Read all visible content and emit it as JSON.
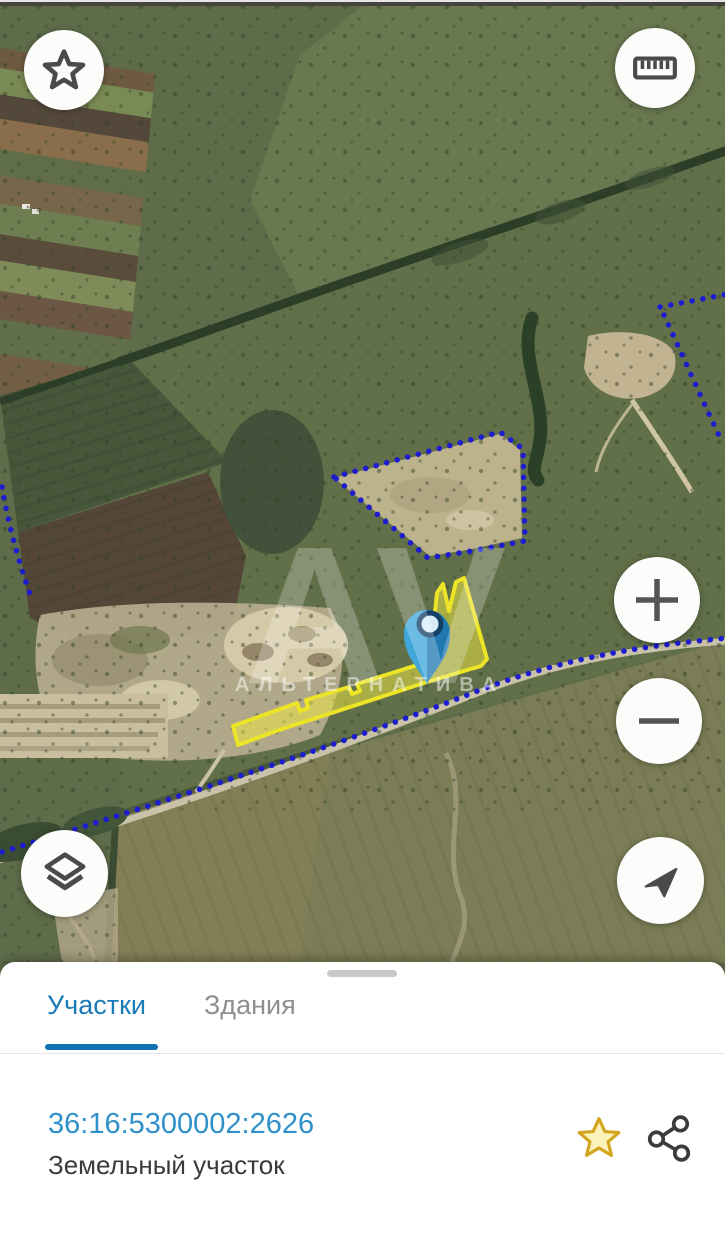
{
  "map": {
    "watermark": {
      "monogram": "АV",
      "name": "АЛЬТЕРНАТИВА"
    },
    "controls": {
      "favorite": "star-button",
      "measure": "ruler-button",
      "zoom_in": "+",
      "zoom_out": "−",
      "layers": "layers-button",
      "my_location": "compass-button"
    },
    "selected_parcel_color": "#ece427",
    "boundary_dot_color": "#1d1dcf",
    "pin_color": "#3fa7da"
  },
  "sheet": {
    "tabs": [
      {
        "label": "Участки",
        "active": true
      },
      {
        "label": "Здания",
        "active": false
      }
    ],
    "plot": {
      "cadastral_number": "36:16:5300002:2626",
      "type_label": "Земельный участок",
      "favorited": true
    }
  },
  "colors": {
    "tab_active": "#1b7ab8",
    "tab_underline": "#1172b2",
    "link_blue": "#3090ca",
    "favorite_fill": "#fcf3bb",
    "favorite_stroke": "#d3a41d"
  }
}
